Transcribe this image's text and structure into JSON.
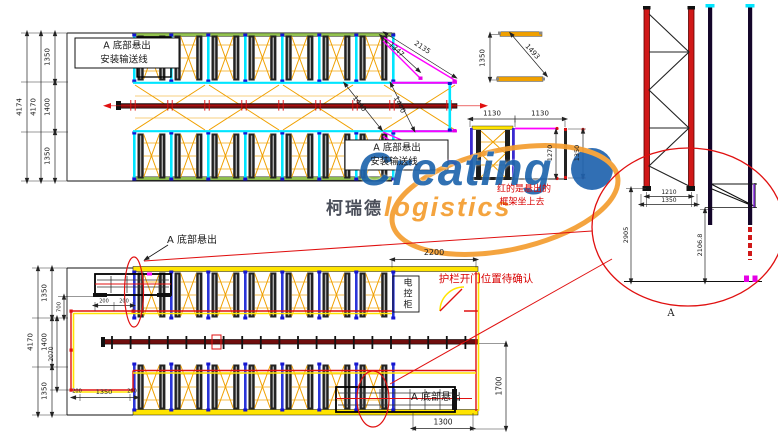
{
  "top_plan": {
    "dim_outer": "4174",
    "dim_inner": "4170",
    "row_dims": [
      "1350",
      "1400",
      "1350"
    ],
    "note_box1": {
      "l1": "A  底部悬出",
      "l2": "安装输送线"
    },
    "note_box2": {
      "l1": "A  底部悬出",
      "l2": "安装输送线"
    },
    "diag_dims": {
      "d1": "2135",
      "d2": "1347",
      "d3": "1440",
      "d4": "1440"
    }
  },
  "corner_detail": {
    "height": "1350",
    "diag": "1493"
  },
  "mid_detail": {
    "w1": "1130",
    "w2": "1130",
    "h_inner": "1270",
    "h_outer": "1350",
    "red_note": {
      "l1": "红的是悬出的",
      "l2": "框架坐上去"
    }
  },
  "elevation": {
    "w_inner": "1210",
    "w_outer": "1350",
    "h_left": "2905",
    "h_right": "2106.8",
    "detail_label": "A"
  },
  "bottom_plan": {
    "dim_outer": "4170",
    "row_dims": [
      "1350",
      "1400",
      "1350"
    ],
    "v_small1": "700",
    "v_small2": "2070",
    "top_small": [
      "200",
      "200"
    ],
    "bottom_small": [
      "200",
      "1350",
      "200"
    ],
    "opening_width": "2200",
    "right_height": "1700",
    "overhang_width": "1300",
    "note_top": "A  底部悬出",
    "note_bottom": "A  底部悬出",
    "red_note": "护栏开门位置待确认",
    "cabinet": "电控柜"
  },
  "logo": {
    "brand": "Creating",
    "cn": "柯瑞德",
    "sub": "logistics"
  },
  "colors": {
    "accent_red": "#e01010",
    "brace_orange": "#f0a000",
    "rail_cyan": "#00e5ff",
    "rail_blue": "#2a35d8",
    "magenta": "#ff00ff",
    "band_green": "#92c24e",
    "band_yellow": "#ffe400",
    "conveyor": "#700d0d",
    "logo_blue": "#1f66ad",
    "logo_orange": "#f49d2f"
  }
}
